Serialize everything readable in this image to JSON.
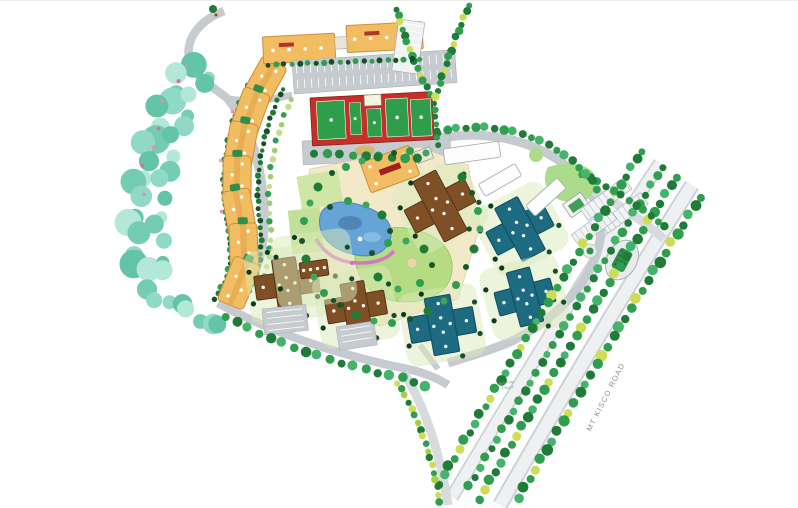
{
  "labels": {
    "road": "MT KISCO ROAD",
    "plaza_line1": "Amenity",
    "plaza_line2": "Plaza"
  },
  "palette": {
    "background": "#ffffff",
    "road_gray": "#c6cbd0",
    "boulevard_edge": "#cdd2d6",
    "boulevard_surface": "#eef0f2",
    "tree_dark": "#1f7c38",
    "tree_mid": "#2f9e4f",
    "tree_light": "#45b36b",
    "tree_accent": "#cddd55",
    "forest_teal_1": "#8fd9c6",
    "forest_teal_2": "#63c4a8",
    "forest_teal_3": "#b3e7d8",
    "hedge_dark": "#16502a",
    "building_orange": "#f2bd62",
    "building_orange_stroke": "#c9913a",
    "building_brown": "#7f5026",
    "building_brown_stroke": "#53351a",
    "building_teal": "#1d6b80",
    "building_teal_stroke": "#0f4c5d",
    "building_white": "#fdfdfd",
    "court_red": "#c23127",
    "court_green": "#2f9e4a",
    "pool_blue": "#66a3d6",
    "pool_deep": "#3c6f9f",
    "path_pink": "#d46ec6",
    "lawn_green": "#b5dc82",
    "panel_green": "#cfe6a5",
    "plaza_cream": "#f2e9c9",
    "flower_pink": "#e88bb0",
    "label_red": "#a02020",
    "label_gray": "#8a9097"
  }
}
